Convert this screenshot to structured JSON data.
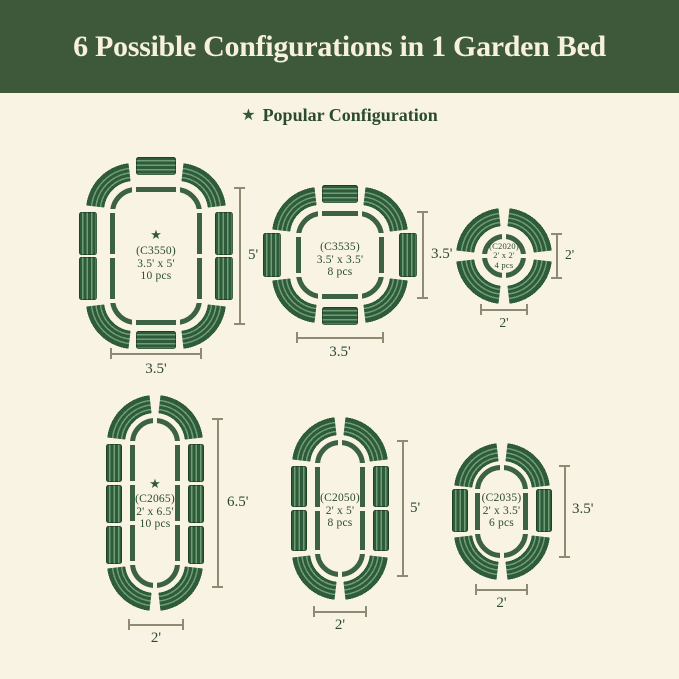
{
  "header": {
    "title": "6 Possible Configurations in 1 Garden Bed"
  },
  "legend": {
    "star_glyph": "★",
    "label": "Popular Configuration"
  },
  "configs": [
    {
      "code": "(C3550)",
      "size": "3.5' x 5'",
      "pcs": "10 pcs",
      "popular": true,
      "height_label": "5'",
      "width_label": "3.5'"
    },
    {
      "code": "(C3535)",
      "size": "3.5' x 3.5'",
      "pcs": "8 pcs",
      "popular": false,
      "height_label": "3.5'",
      "width_label": "3.5'"
    },
    {
      "code": "(C2020)",
      "size": "2' x 2'",
      "pcs": "4 pcs",
      "popular": false,
      "height_label": "2'",
      "width_label": "2'"
    },
    {
      "code": "(C2065)",
      "size": "2' x 6.5'",
      "pcs": "10 pcs",
      "popular": true,
      "height_label": "6.5'",
      "width_label": "2'"
    },
    {
      "code": "(C2050)",
      "size": "2' x 5'",
      "pcs": "8 pcs",
      "popular": false,
      "height_label": "5'",
      "width_label": "2'"
    },
    {
      "code": "(C2035)",
      "size": "2' x 3.5'",
      "pcs": "6 pcs",
      "popular": false,
      "height_label": "3.5'",
      "width_label": "2'"
    }
  ],
  "colors": {
    "banner_green": "#3E5939",
    "background_cream": "#F9F3E3",
    "text_green": "#2B4B30",
    "outline_green": "#3C6243",
    "panel_dark": "#2E5B39",
    "panel_stripe_light": "#6F9D74",
    "dimension_line": "#8D8B74"
  }
}
